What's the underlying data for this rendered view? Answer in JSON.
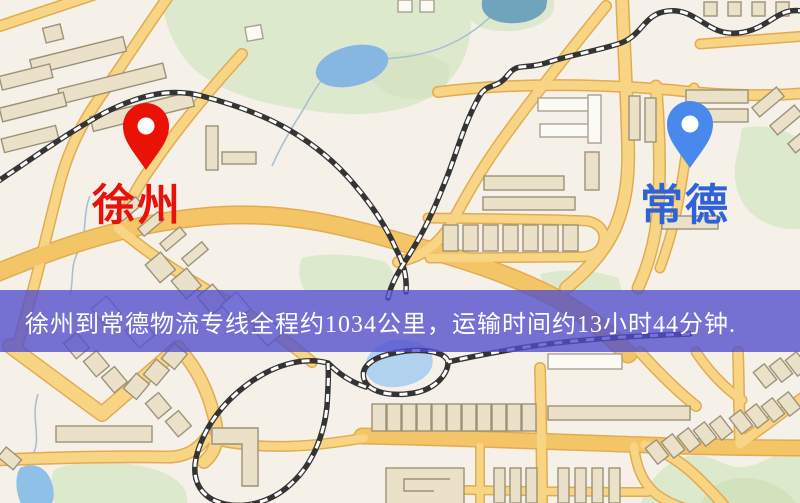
{
  "map": {
    "markers": [
      {
        "name": "徐州",
        "role": "origin",
        "icon": "map-pin-icon",
        "pin_color": "#ea1205",
        "label_color": "#e8120a"
      },
      {
        "name": "常德",
        "role": "destination",
        "icon": "map-pin-icon",
        "pin_color": "#4a89ec",
        "label_color": "#2f62d6"
      }
    ],
    "palette": {
      "background": "#f5f1e8",
      "road": "#f8d584",
      "road_major": "#f4c566",
      "road_border": "#e2ab52",
      "park": "#dde9cd",
      "water": "#85b7e2",
      "building": "#eae1c8",
      "railway": "#343434"
    }
  },
  "banner": {
    "text": "徐州到常德物流专线全程约1034公里，运输时间约13小时44分钟.",
    "background_color": "#504dcd",
    "text_color": "#ffffff"
  }
}
